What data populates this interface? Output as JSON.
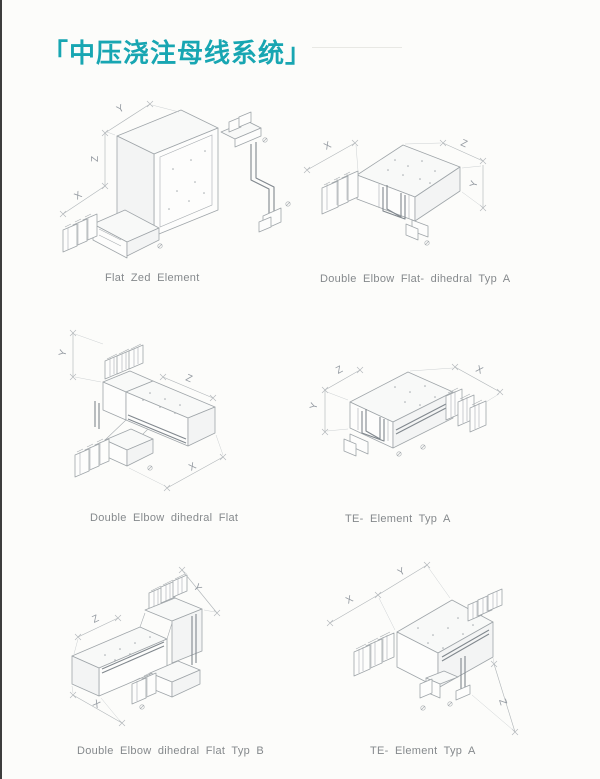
{
  "page": {
    "title": "「中压浇注母线系统」",
    "accent_color": "#18a6b2"
  },
  "figures": [
    {
      "caption": "Flat Zed Element",
      "dims": [
        "Y",
        "Z",
        "X"
      ]
    },
    {
      "caption": "Double Elbow Flat- dihedral Typ A",
      "dims": [
        "X",
        "Z",
        "Y"
      ]
    },
    {
      "caption": "Double Elbow dihedral Flat",
      "dims": [
        "Y",
        "Z",
        "X"
      ]
    },
    {
      "caption": "TE- Element Typ A",
      "dims": [
        "Z",
        "X",
        "Y"
      ]
    },
    {
      "caption": "Double Elbow dihedral Flat Typ B",
      "dims": [
        "Z",
        "Y",
        "X"
      ]
    },
    {
      "caption": "TE- Element Typ A",
      "dims": [
        "X",
        "Y",
        "Z"
      ]
    }
  ]
}
